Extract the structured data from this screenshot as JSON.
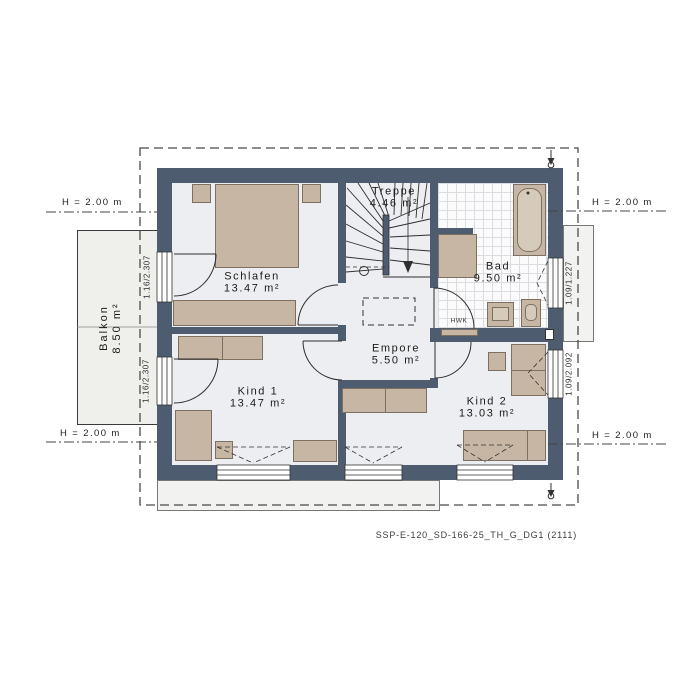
{
  "caption": "SSP-E-120_SD-166-25_TH_G_DG1 (2111)",
  "rooms": {
    "schlafen": {
      "name": "Schlafen",
      "area": "13.47 m²"
    },
    "treppe": {
      "name": "Treppe",
      "area": "4.46 m²"
    },
    "bad": {
      "name": "Bad",
      "area": "9.50 m²"
    },
    "empore": {
      "name": "Empore",
      "area": "5.50 m²"
    },
    "kind1": {
      "name": "Kind 1",
      "area": "13.47 m²"
    },
    "kind2": {
      "name": "Kind 2",
      "area": "13.03 m²"
    },
    "balkon": {
      "name": "Balkon",
      "area": "8.50 m²"
    }
  },
  "dims": {
    "h_left_top": "H = 2.00 m",
    "h_left_bottom": "H = 2.00 m",
    "h_right_top": "H = 2.00 m",
    "h_right_bottom": "H = 2.00 m",
    "balcony_door_schlafen": "1.16/2.307",
    "balcony_door_kind1": "1.16/2.307",
    "window_bad": "1.09/1.227",
    "window_kind2": "1.09/2.092"
  },
  "annotations": {
    "hwk": "HWK"
  },
  "colors": {
    "wall": "#4d5c6e",
    "floor": "#edeef1",
    "furniture": "#c7b6a3",
    "balcony": "#efefec",
    "outside_roof": "#f2f2f0",
    "tile": "#fbfbfb",
    "tile_line": "#d9dde1",
    "line": "#2e2e2e",
    "dashed_outline": "#4a4a4a"
  }
}
